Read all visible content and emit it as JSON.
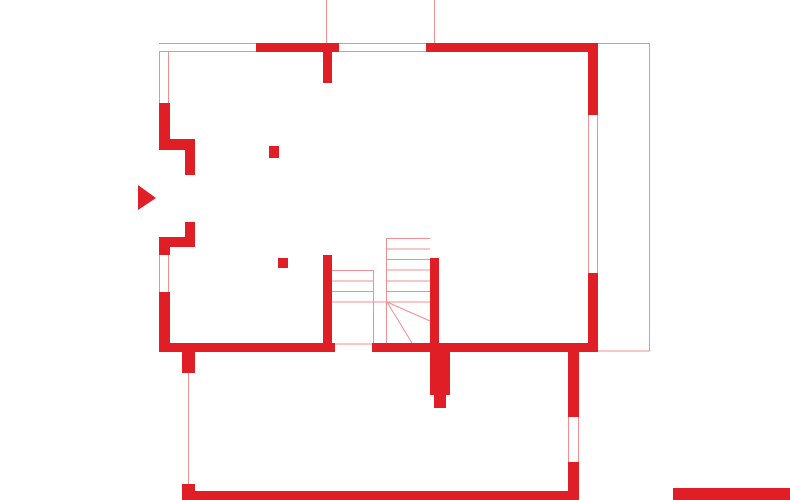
{
  "drawing": {
    "kind": "architectural-floor-plan",
    "canvas": {
      "width": 790,
      "height": 500
    },
    "colors": {
      "wall": "#e01e25",
      "hairline": "#ef8f93",
      "background": "#ffffff"
    },
    "plan": {
      "walls": [
        {
          "name": "top-wall-segment-a",
          "x": 255,
          "y": 43,
          "w": 84,
          "h": 9
        },
        {
          "name": "top-wall-stub",
          "x": 323,
          "y": 52,
          "w": 9,
          "h": 31
        },
        {
          "name": "top-wall-segment-b",
          "x": 426,
          "y": 43,
          "w": 172,
          "h": 9
        },
        {
          "name": "right-wall-upper",
          "x": 588,
          "y": 43,
          "w": 10,
          "h": 72
        },
        {
          "name": "right-wall-lower",
          "x": 588,
          "y": 273,
          "w": 10,
          "h": 79
        },
        {
          "name": "left-wall-upper",
          "x": 159,
          "y": 103,
          "w": 11,
          "h": 40
        },
        {
          "name": "entry-jog-upper",
          "x": 159,
          "y": 139,
          "w": 36,
          "h": 11
        },
        {
          "name": "entry-jamb-upper",
          "x": 185,
          "y": 150,
          "w": 10,
          "h": 25
        },
        {
          "name": "entry-jamb-lower",
          "x": 185,
          "y": 222,
          "w": 10,
          "h": 25
        },
        {
          "name": "entry-jog-lower",
          "x": 159,
          "y": 237,
          "w": 36,
          "h": 10
        },
        {
          "name": "left-wall-middle",
          "x": 159,
          "y": 237,
          "w": 11,
          "h": 18
        },
        {
          "name": "left-wall-lower",
          "x": 159,
          "y": 292,
          "w": 11,
          "h": 60
        },
        {
          "name": "bottom-wall-left",
          "x": 159,
          "y": 343,
          "w": 176,
          "h": 9
        },
        {
          "name": "bottom-wall-right",
          "x": 372,
          "y": 343,
          "w": 226,
          "h": 9
        },
        {
          "name": "stair-wall-left",
          "x": 323,
          "y": 255,
          "w": 9,
          "h": 88
        },
        {
          "name": "stair-wall-right",
          "x": 430,
          "y": 258,
          "w": 9,
          "h": 85
        },
        {
          "name": "chimney-base",
          "x": 430,
          "y": 343,
          "w": 20,
          "h": 52
        },
        {
          "name": "chimney-stub",
          "x": 434,
          "y": 395,
          "w": 12,
          "h": 13
        },
        {
          "name": "basement-pier-upper",
          "x": 182,
          "y": 352,
          "w": 13,
          "h": 21
        },
        {
          "name": "basement-pier-lower",
          "x": 182,
          "y": 484,
          "w": 13,
          "h": 16
        },
        {
          "name": "basement-bottom-wall",
          "x": 193,
          "y": 491,
          "w": 385,
          "h": 9
        },
        {
          "name": "basement-right-wall-upper",
          "x": 568,
          "y": 352,
          "w": 11,
          "h": 65
        },
        {
          "name": "basement-right-wall-lower",
          "x": 568,
          "y": 462,
          "w": 11,
          "h": 38
        },
        {
          "name": "neighbor-wall-fragment",
          "x": 673,
          "y": 488,
          "w": 117,
          "h": 12
        }
      ],
      "windows": [
        {
          "name": "window-top-left",
          "x": 159,
          "y": 43,
          "w": 97,
          "h": 9,
          "o": "h"
        },
        {
          "name": "window-left-upper",
          "x": 159,
          "y": 52,
          "w": 10,
          "h": 51,
          "o": "v"
        },
        {
          "name": "window-top-middle",
          "x": 339,
          "y": 43,
          "w": 87,
          "h": 9,
          "o": "h"
        },
        {
          "name": "window-right",
          "x": 588,
          "y": 115,
          "w": 10,
          "h": 158,
          "o": "v"
        },
        {
          "name": "window-left-lower",
          "x": 159,
          "y": 255,
          "w": 10,
          "h": 37,
          "o": "v"
        },
        {
          "name": "window-basement-right",
          "x": 568,
          "y": 417,
          "w": 11,
          "h": 45,
          "o": "v"
        }
      ],
      "columns": [
        {
          "name": "column-1",
          "x": 269,
          "y": 146,
          "w": 10,
          "h": 12
        },
        {
          "name": "column-2",
          "x": 278,
          "y": 258,
          "w": 10,
          "h": 10
        }
      ],
      "lines": [
        {
          "name": "axis-line-top-1",
          "x1": 326.5,
          "y1": 0,
          "x2": 326.5,
          "y2": 43
        },
        {
          "name": "axis-line-top-2",
          "x1": 434.5,
          "y1": 0,
          "x2": 434.5,
          "y2": 43
        },
        {
          "name": "terrace-top-edge",
          "x1": 598,
          "y1": 43.5,
          "x2": 650,
          "y2": 43.5
        },
        {
          "name": "terrace-right-edge",
          "x1": 649.5,
          "y1": 43,
          "x2": 649.5,
          "y2": 351
        },
        {
          "name": "terrace-bottom-edge",
          "x1": 598,
          "y1": 351,
          "x2": 650,
          "y2": 351
        },
        {
          "name": "door-threshold-line",
          "x1": 335,
          "y1": 344,
          "x2": 372,
          "y2": 344
        },
        {
          "name": "basement-left-edge",
          "x1": 188.5,
          "y1": 373,
          "x2": 188.5,
          "y2": 484
        },
        {
          "name": "stair-tread-1",
          "x1": 332,
          "y1": 270.5,
          "x2": 373,
          "y2": 270.5
        },
        {
          "name": "stair-tread-2",
          "x1": 332,
          "y1": 281,
          "x2": 373,
          "y2": 281
        },
        {
          "name": "stair-tread-3",
          "x1": 332,
          "y1": 291.5,
          "x2": 373,
          "y2": 291.5
        },
        {
          "name": "stair-landing-edge",
          "x1": 332,
          "y1": 302,
          "x2": 387,
          "y2": 302
        },
        {
          "name": "stair-stringer-left",
          "x1": 373.5,
          "y1": 270,
          "x2": 373.5,
          "y2": 343
        },
        {
          "name": "stair-stringer-right",
          "x1": 386.5,
          "y1": 238,
          "x2": 386.5,
          "y2": 343
        },
        {
          "name": "stair-tread-4",
          "x1": 386,
          "y1": 238.5,
          "x2": 430,
          "y2": 238.5
        },
        {
          "name": "stair-tread-5",
          "x1": 386,
          "y1": 249,
          "x2": 430,
          "y2": 249
        },
        {
          "name": "stair-tread-6",
          "x1": 386,
          "y1": 259.5,
          "x2": 430,
          "y2": 259.5
        },
        {
          "name": "stair-tread-7",
          "x1": 386,
          "y1": 270,
          "x2": 430,
          "y2": 270
        },
        {
          "name": "stair-tread-8",
          "x1": 386,
          "y1": 281,
          "x2": 430,
          "y2": 281
        },
        {
          "name": "stair-tread-9",
          "x1": 386,
          "y1": 291.5,
          "x2": 430,
          "y2": 291.5
        },
        {
          "name": "stair-tread-10",
          "x1": 386,
          "y1": 302,
          "x2": 430,
          "y2": 302
        },
        {
          "name": "stair-break-line-1",
          "x1": 387,
          "y1": 302,
          "x2": 430,
          "y2": 321
        },
        {
          "name": "stair-break-line-2",
          "x1": 387,
          "y1": 302,
          "x2": 412,
          "y2": 343
        }
      ],
      "arrow": {
        "name": "entrance-arrow",
        "points": "138,185 138,210 156,198"
      }
    }
  }
}
